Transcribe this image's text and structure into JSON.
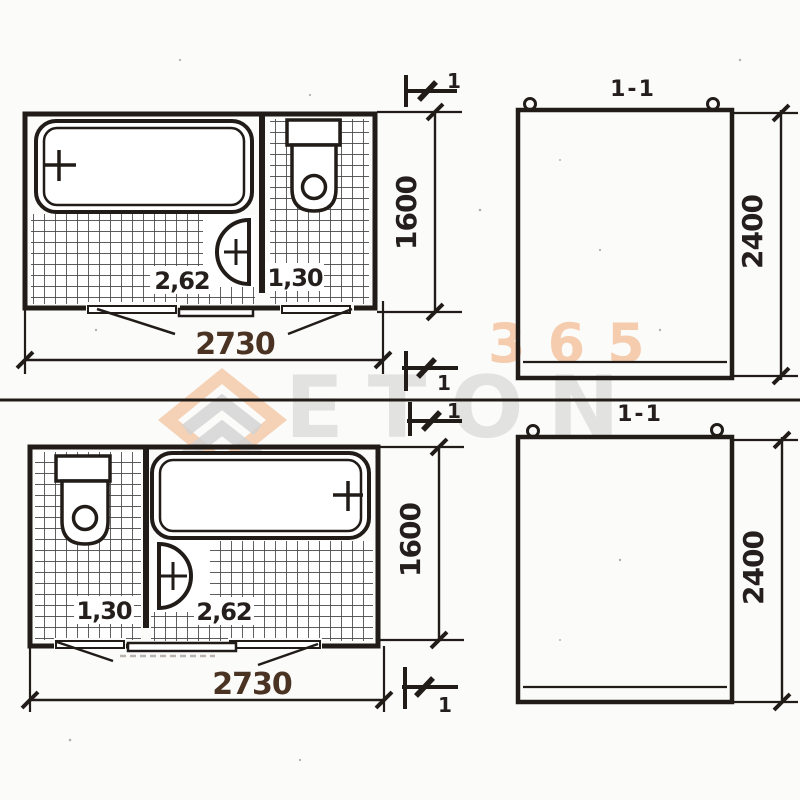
{
  "page": {
    "background": "#fbfbfa",
    "ink": "#211c18",
    "dim_label_color": "#4a3322"
  },
  "watermark": {
    "brand_gray": "ETON",
    "brand_orange": "365",
    "orange": "#ef9f63",
    "gray": "#dcdcdc"
  },
  "top_drawing": {
    "plan": {
      "width": "2730",
      "depth": "1600",
      "bath_area": "2,62",
      "wc_area": "1,30",
      "section_mark": "1"
    },
    "section": {
      "title": "1-1",
      "height": "2400"
    }
  },
  "bottom_drawing": {
    "plan": {
      "width": "2730",
      "depth": "1600",
      "bath_area": "2,62",
      "wc_area": "1,30",
      "section_mark": "1"
    },
    "section": {
      "title": "1-1",
      "height": "2400"
    }
  }
}
